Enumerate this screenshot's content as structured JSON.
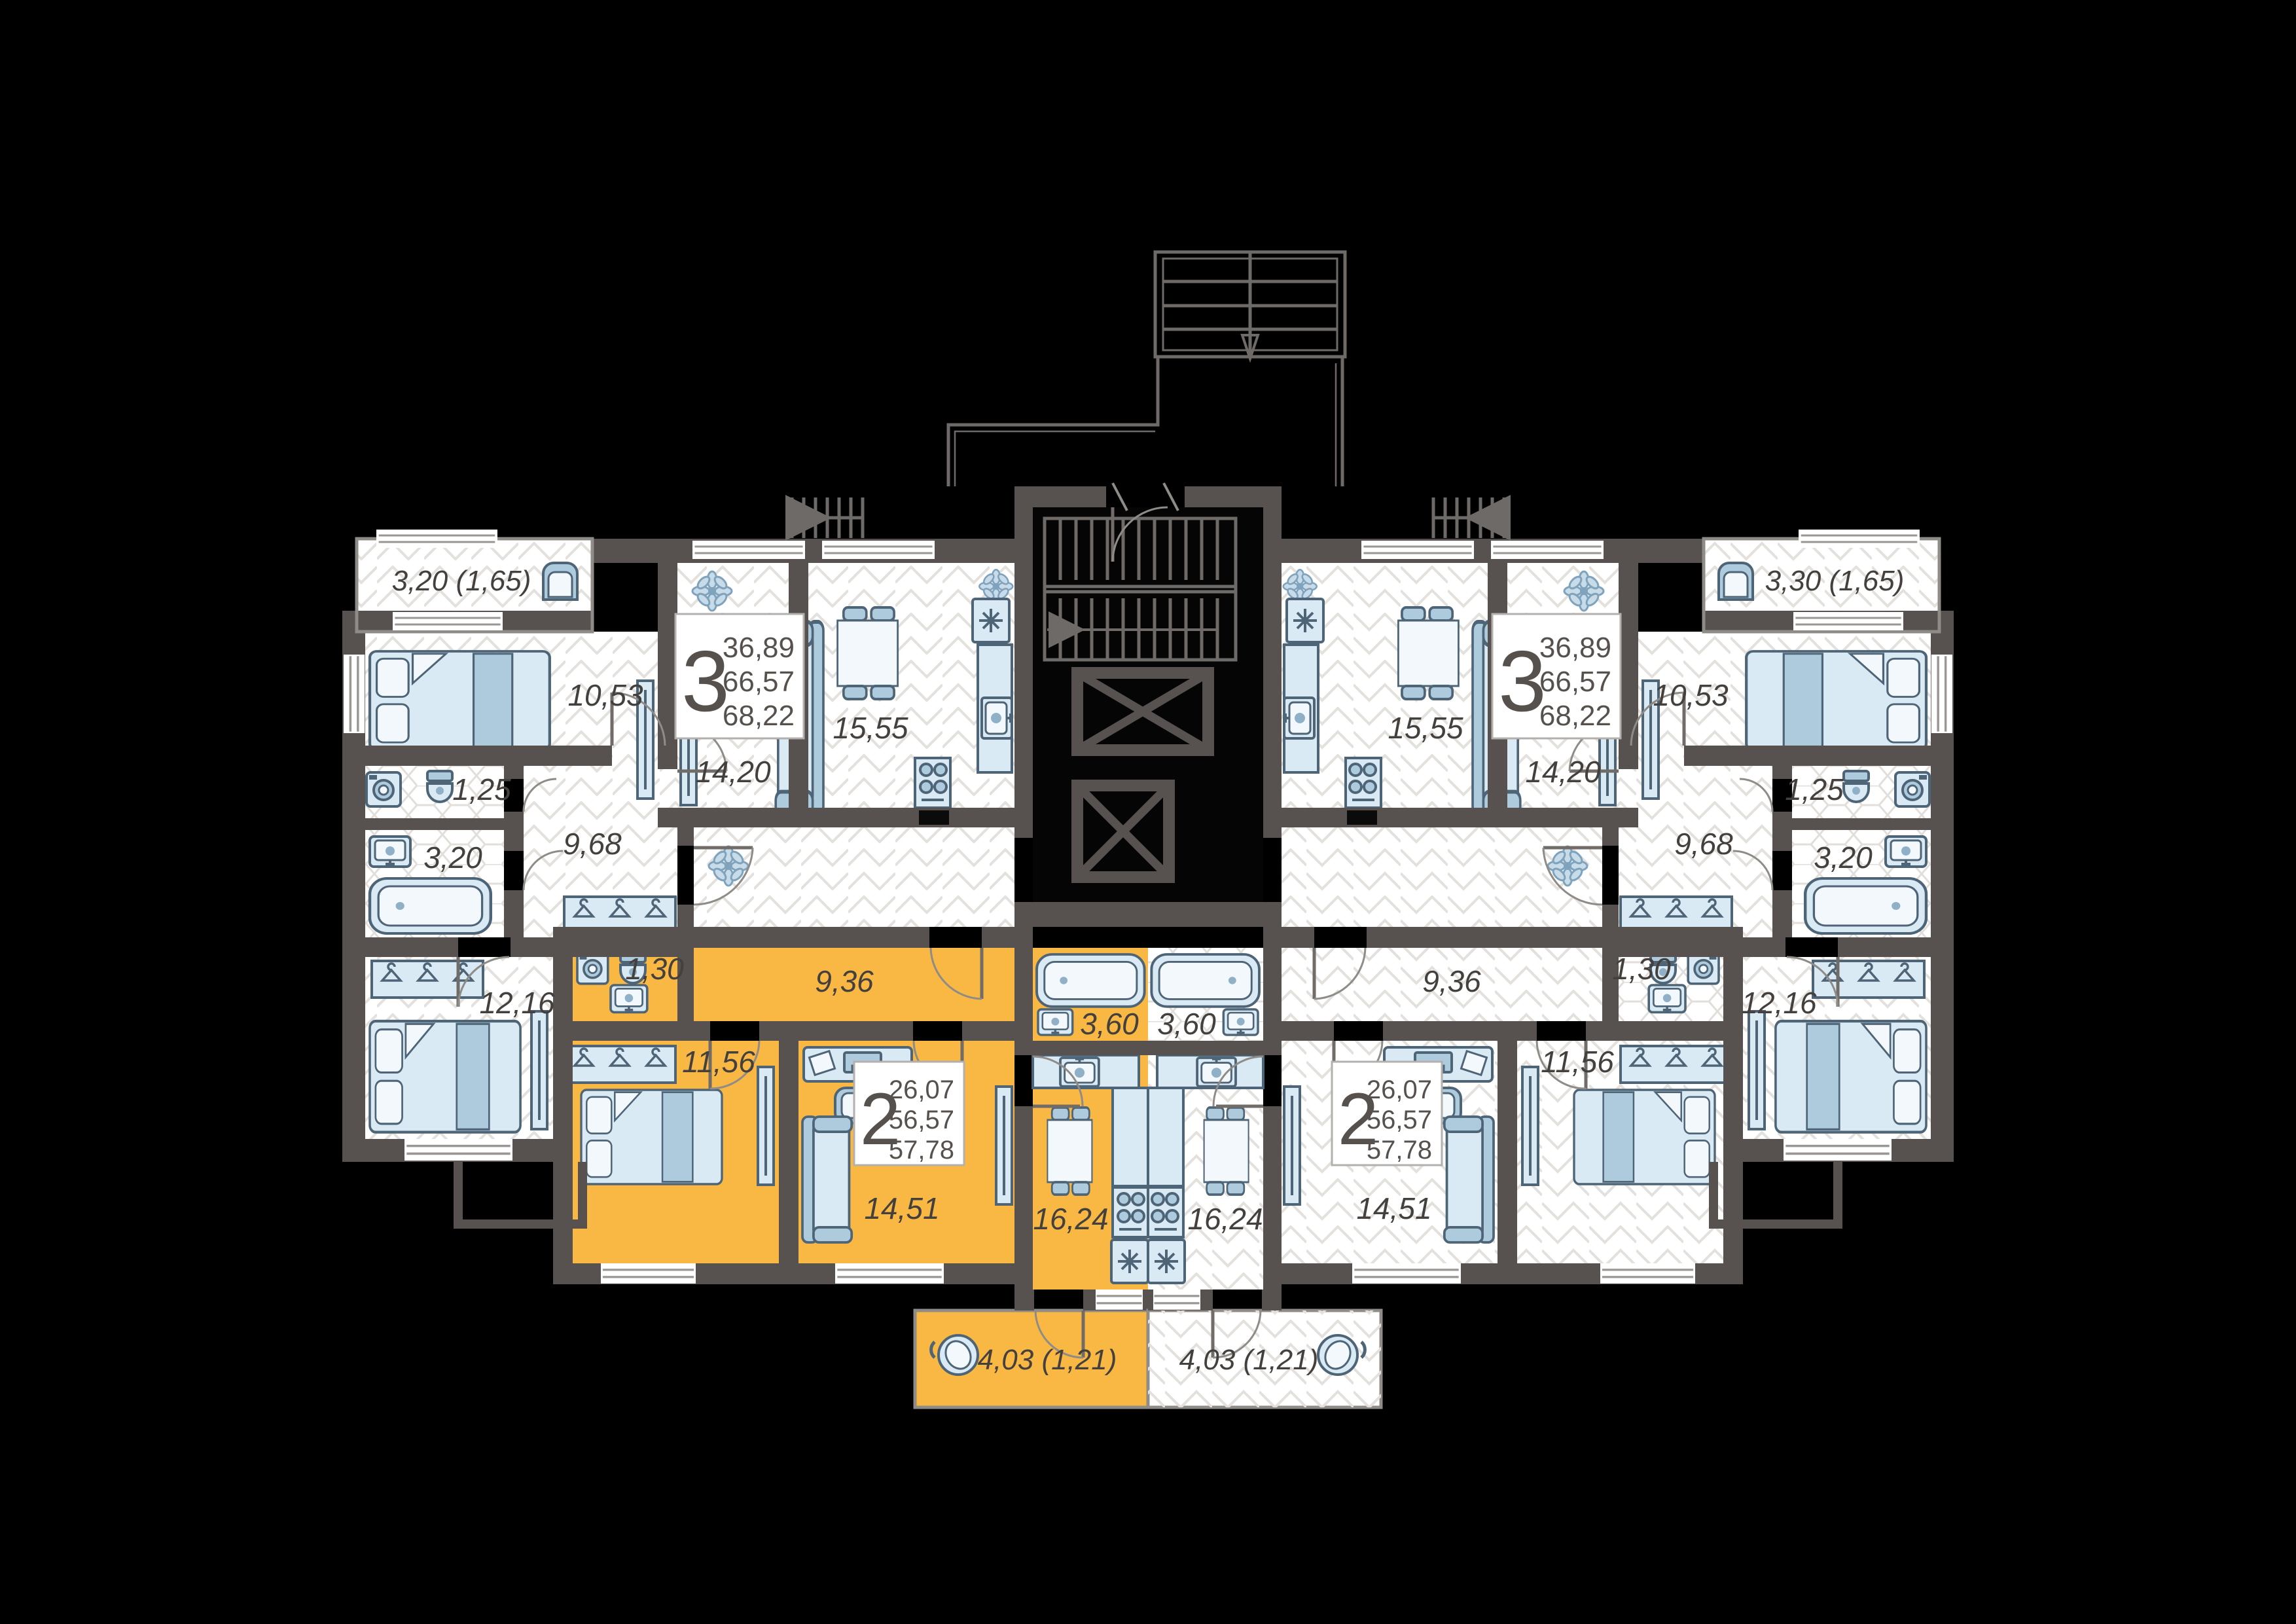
{
  "title": "Residential floor plan",
  "colors": {
    "background": "#000000",
    "walls": "#575150",
    "highlight": "#F8B843",
    "furniture": "#D9EAF5",
    "text": "#44403D"
  },
  "apartments": {
    "left3": {
      "label": "3-room apartment (left)",
      "spec": {
        "rooms": "3",
        "living": "36,89",
        "usable": "66,57",
        "total": "68,22"
      },
      "rooms": {
        "balcony": "3,20 (1,65)",
        "bedroom1": "10,53",
        "living": "14,20",
        "kitchen": "15,55",
        "wc": "1,25",
        "bathroom": "3,20",
        "hall": "9,68",
        "bedroom2": "12,16"
      }
    },
    "left2": {
      "label": "2-room apartment (left, highlighted)",
      "highlighted": true,
      "spec": {
        "rooms": "2",
        "living": "26,07",
        "usable": "56,57",
        "total": "57,78"
      },
      "rooms": {
        "wc": "1,30",
        "hall": "9,36",
        "bedroom": "11,56",
        "living": "14,51",
        "kitchen": "16,24",
        "bathroom": "3,60",
        "balcony": "4,03 (1,21)"
      }
    },
    "right2": {
      "label": "2-room apartment (right)",
      "highlighted": false,
      "spec": {
        "rooms": "2",
        "living": "26,07",
        "usable": "56,57",
        "total": "57,78"
      },
      "rooms": {
        "wc": "1,30",
        "hall": "9,36",
        "bedroom": "11,56",
        "living": "14,51",
        "kitchen": "16,24",
        "bathroom": "3,60",
        "balcony": "4,03 (1,21)"
      }
    },
    "right3": {
      "label": "3-room apartment (right)",
      "spec": {
        "rooms": "3",
        "living": "36,89",
        "usable": "66,57",
        "total": "68,22"
      },
      "rooms": {
        "balcony": "3,30 (1,65)",
        "bedroom1": "10,53",
        "living": "14,20",
        "kitchen": "15,55",
        "wc": "1,25",
        "bathroom": "3,20",
        "hall": "9,68",
        "bedroom2": "12,16"
      }
    }
  }
}
